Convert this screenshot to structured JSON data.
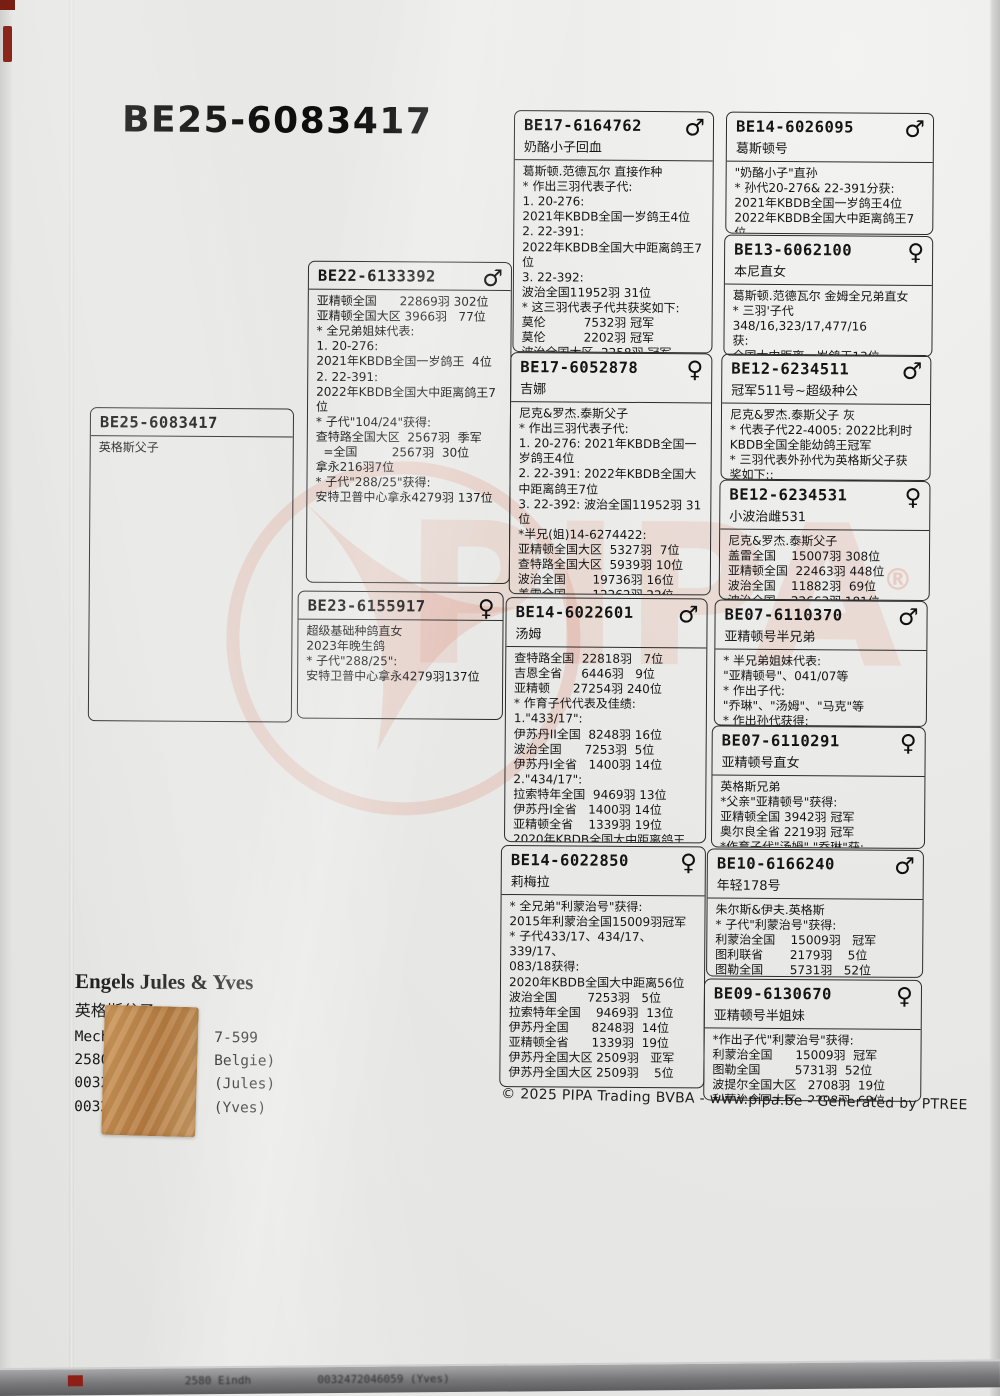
{
  "page": {
    "title": "BE25-6083417",
    "footer": "© 2025 PIPA Trading BVBA - www.pipa.be - Generated by PTREE",
    "watermark_text": "PIPA",
    "registered_mark": "®",
    "watermark_color": "#de785c",
    "bottom_strip_text": "2580 Eindh          0032472046059 (Yves)"
  },
  "owner": {
    "name_en": "Engels Jules & Yves",
    "name_cn": "英格斯父子",
    "lines": [
      "Mech            7-599",
      "2580            Belgie)",
      "0032            (Jules)",
      "0032            (Yves)"
    ]
  },
  "boxes": {
    "subject": {
      "ring": "BE25-6083417",
      "lines": [
        "英格斯父子"
      ]
    },
    "sire": {
      "ring": "BE22-6133392",
      "sex_symbol": "♂",
      "lines": [
        "亚精顿全国      22869羽 302位",
        "亚精顿全国大区 3966羽   77位",
        "* 全兄弟姐妹代表:",
        "1. 20-276:",
        "2021年KBDB全国一岁鸽王  4位",
        "2. 22-391:",
        "2022年KBDB全国大中距离鸽王7位",
        "* 子代\"104/24\"获得:",
        "查特路全国大区  2567羽  季军",
        "  =全国         2567羽  30位",
        "拿永216羽7位",
        "* 子代\"288/25\"获得:",
        "安特卫普中心拿永4279羽 137位"
      ]
    },
    "dam": {
      "ring": "BE23-6155917",
      "sex_symbol": "♀",
      "lines": [
        "超级基础种鸽直女",
        "2023年晚生鸽",
        "* 子代\"288/25\":",
        "安特卫普中心拿永4279羽137位"
      ]
    },
    "g3_1": {
      "ring": "BE17-6164762",
      "name": "奶酪小子回血",
      "sex_symbol": "♂",
      "lines": [
        "葛斯顿.范德瓦尔 直接作种",
        "* 作出三羽代表子代:",
        "1. 20-276:",
        "2021年KBDB全国一岁鸽王4位",
        "2. 22-391:",
        "2022年KBDB全国大中距离鸽王7位",
        "3. 22-392:",
        "波治全国11952羽 31位",
        "* 这三羽代表子代共获奖如下:",
        "莫伦          7532羽 冠军",
        "莫伦          2202羽 冠军",
        "波治全国大区  2258羽 冠军",
        "赛迈斯        2439羽 亚军"
      ]
    },
    "g3_2": {
      "ring": "BE17-6052878",
      "name": "吉娜",
      "sex_symbol": "♀",
      "lines": [
        "尼克&罗杰.泰斯父子",
        "* 作出三羽代表子代:",
        "1. 20-276: 2021年KBDB全国一岁鸽王4位",
        "2. 22-391: 2022年KBDB全国大中距离鸽王7位",
        "3. 22-392: 波治全国11952羽 31位",
        "*半兄(姐)14-6274422:",
        "亚精顿全国大区  5327羽  7位",
        "查特路全国大区  5939羽 10位",
        "波治全国       19736羽 16位",
        "盖雷全国       12262羽 22位"
      ]
    },
    "g3_3": {
      "ring": "BE14-6022601",
      "name": "汤姆",
      "sex_symbol": "♂",
      "lines": [
        "查特路全国  22818羽   7位",
        "吉恩全省     6446羽   9位",
        "亚精顿      27254羽 240位",
        "* 作育子代代表及佳绩:",
        "1.\"433/17\":",
        "伊苏丹II全国  8248羽 16位",
        "波治全国      7253羽  5位",
        "伊苏丹I全省   1400羽 14位",
        "2.\"434/17\":",
        "拉索特年全国  9469羽 13位",
        "伊苏丹I全省   1400羽 14位",
        "亚精顿全省    1339羽 19位",
        "2020年KBDB全国大中距离鸽王56位"
      ]
    },
    "g3_4": {
      "ring": "BE14-6022850",
      "name": "莉梅拉",
      "sex_symbol": "♀",
      "lines": [
        "* 全兄弟\"利蒙治号\"获得:",
        "2015年利蒙治全国15009羽冠军",
        "* 子代433/17、434/17、339/17、",
        "083/18获得:",
        "2020年KBDB全国大中距离56位",
        "波治全国        7253羽   5位",
        "拉索特年全国    9469羽  13位",
        "伊苏丹全国      8248羽  14位",
        "亚精顿全省      1339羽  19位",
        "伊苏丹全国大区 2509羽   亚军",
        "伊苏丹全国大区 2509羽    5位"
      ]
    },
    "g4_1": {
      "ring": "BE14-6026095",
      "name": "葛斯顿号",
      "sex_symbol": "♂",
      "lines": [
        "\"奶酪小子\"直孙",
        "* 孙代20-276& 22-391分获:",
        "2021年KBDB全国一岁鸽王4位",
        "2022年KBDB全国大中距离鸽王7位",
        "* 子代获得:"
      ]
    },
    "g4_2": {
      "ring": "BE13-6062100",
      "name": "本尼直女",
      "sex_symbol": "♀",
      "lines": [
        "葛斯顿.范德瓦尔 金姆全兄弟直女",
        "* 三羽'子代348/16,323/17,477/16",
        "获:",
        "全国大中距离一岁鸽王13位",
        "查特路全国        4389羽 亚军"
      ]
    },
    "g4_3": {
      "ring": "BE12-6234511",
      "name": "冠军511号~超级种公",
      "sex_symbol": "♂",
      "lines": [
        "尼克&罗杰.泰斯父子 灰",
        "* 代表子代22-4005: 2022比利时",
        "KBDB全国全能幼鸽王冠军",
        "* 三羽代表外孙代为英格斯父子获",
        "奖如下::"
      ]
    },
    "g4_4": {
      "ring": "BE12-6234531",
      "name": "小波治雌531",
      "sex_symbol": "♀",
      "lines": [
        "尼克&罗杰.泰斯父子",
        "盖雷全国    15007羽 308位",
        "亚精顿全国  22463羽 448位",
        "波治全国    11882羽  69位",
        "波治全国    22663羽 181位"
      ]
    },
    "g4_5": {
      "ring": "BE07-6110370",
      "name": "亚精顿号半兄弟",
      "sex_symbol": "♂",
      "lines": [
        "* 半兄弟姐妹代表:",
        "\"亚精顿号\"、041/07等",
        "* 作出子代:",
        "\"乔琳\"、\"汤姆\"、\"马克\"等",
        "* 作出孙代获得:"
      ]
    },
    "g4_6": {
      "ring": "BE07-6110291",
      "name": "亚精顿号直女",
      "sex_symbol": "♀",
      "lines": [
        "英格斯兄弟",
        "*父亲\"亚精顿号\"获得:",
        "亚精顿全国 3942羽 冠军",
        "奥尔良全省 2219羽 冠军",
        "*作育子代\"汤姆\".\"乔琳\"获:"
      ]
    },
    "g4_7": {
      "ring": "BE10-6166240",
      "name": "年轻178号",
      "sex_symbol": "♂",
      "lines": [
        "朱尔斯&伊夫.英格斯",
        "* 子代\"利蒙治号\"获得:",
        "利蒙治全国    15009羽   冠军",
        "图利联省       2179羽    5位",
        "图勒全国       5731羽   52位"
      ]
    },
    "g4_8": {
      "ring": "BE09-6130670",
      "name": "亚精顿号半姐妹",
      "sex_symbol": "♀",
      "lines": [
        "*作出子代\"利蒙治号\"获得:",
        "利蒙治全国      15009羽  冠军",
        "图勒全国         5731羽  52位",
        "波提尔全国大区   2708羽  19位",
        "利蒙治全国大区   2298羽  68位"
      ]
    }
  }
}
